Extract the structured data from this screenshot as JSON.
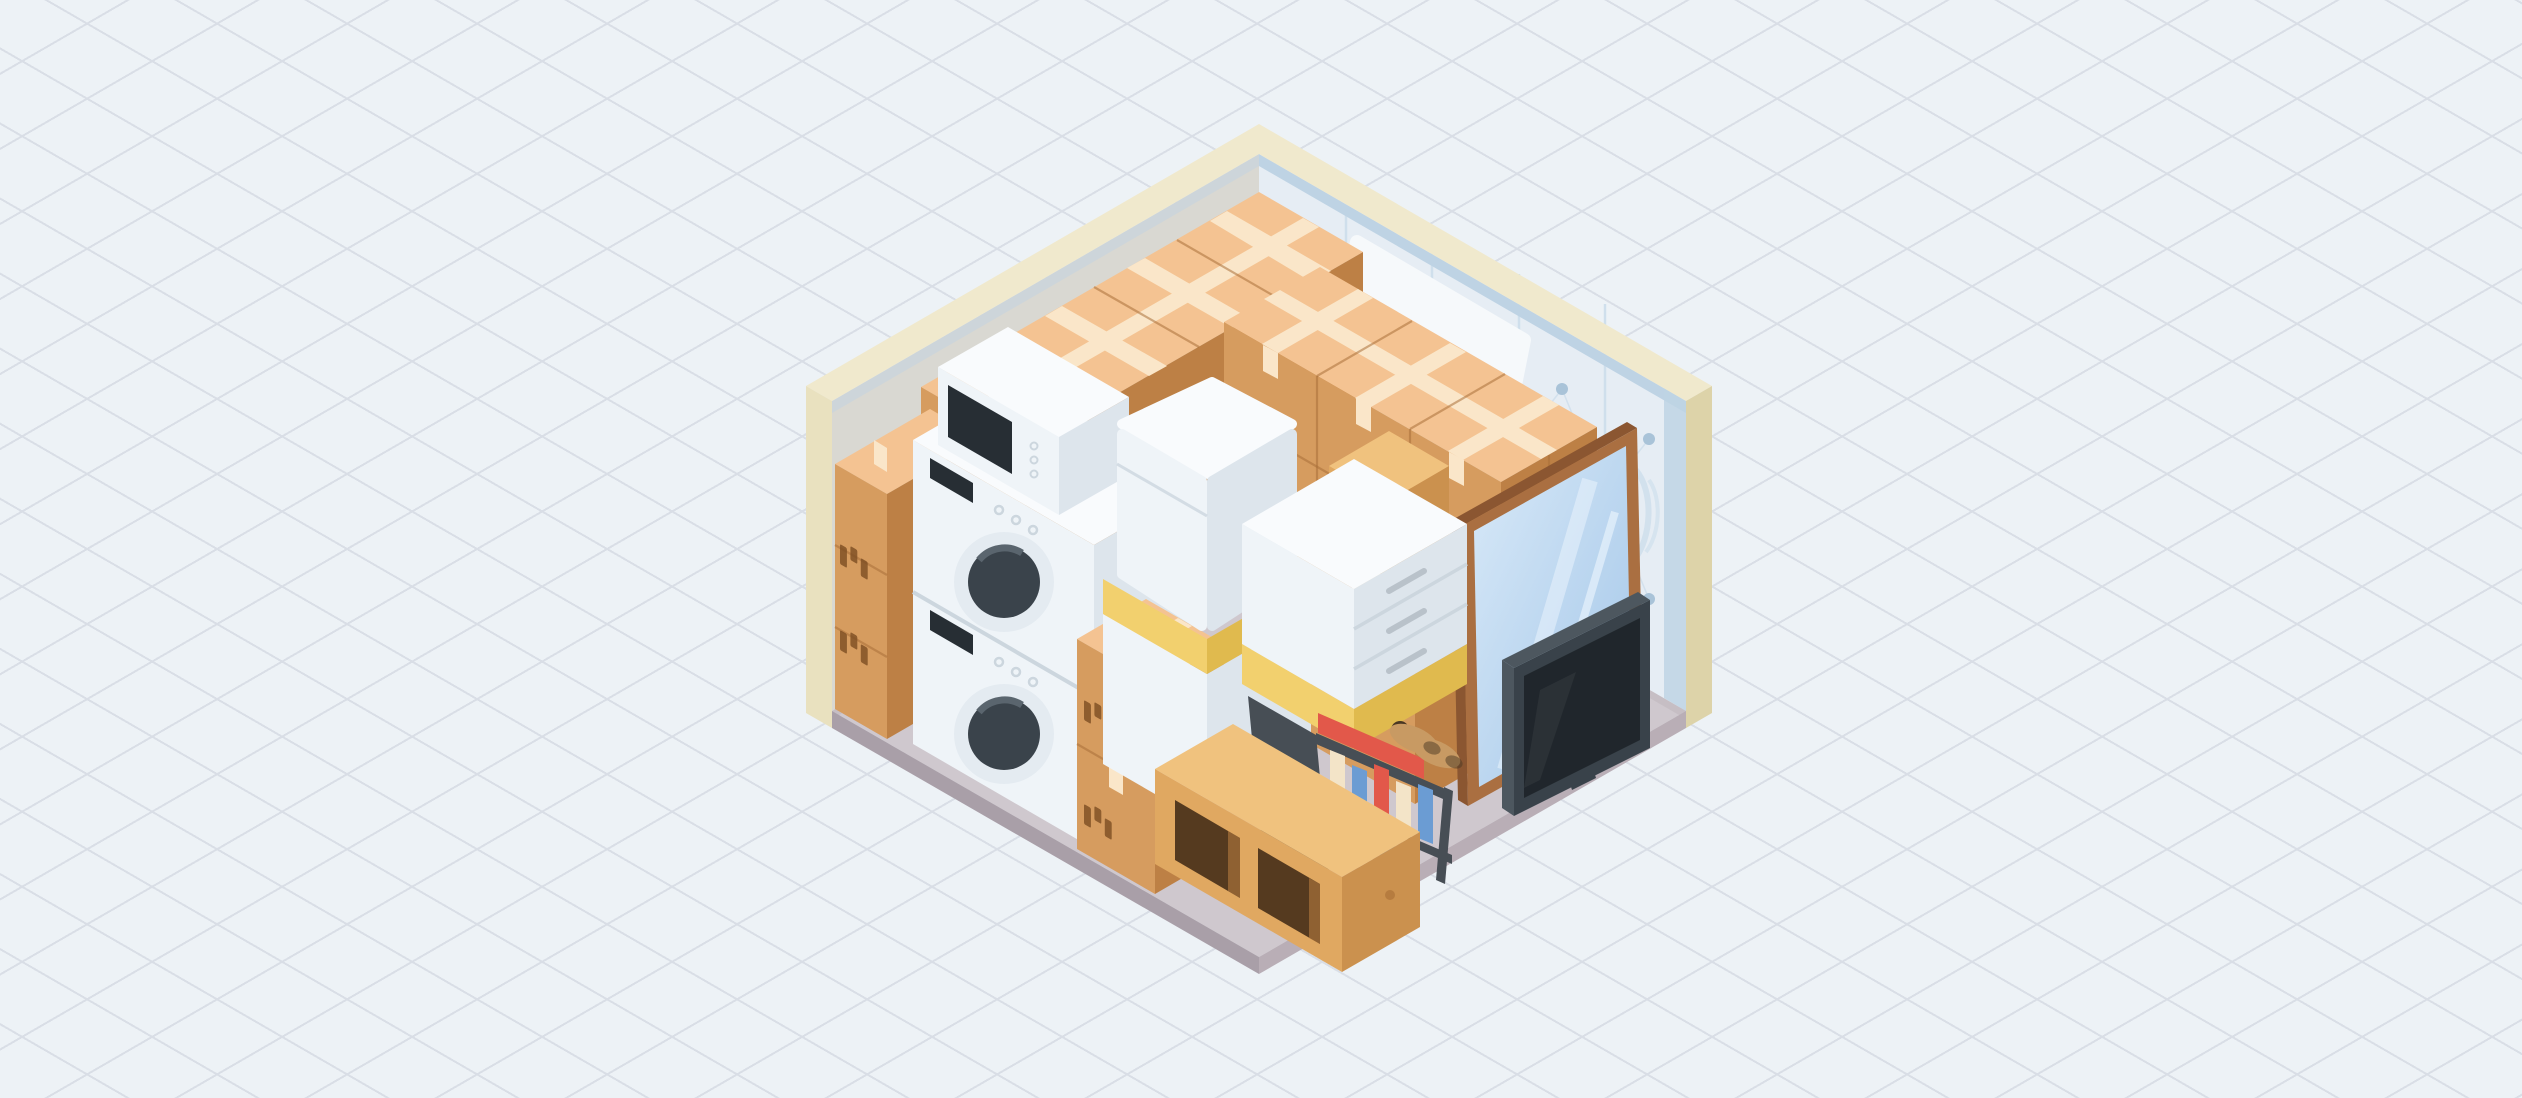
{
  "scene": {
    "name": "packed-self-storage-unit",
    "style": "isometric-cutaway-illustration",
    "background": "isometric-diamond-grid",
    "items": [
      "cardboard-box-wall-left",
      "cardboard-box-wall-back",
      "corner-box-column",
      "leaning-mattress",
      "stacked-washer-dryer",
      "microwave",
      "front-box-stack",
      "white-cabinet-with-mattress",
      "white-dresser-on-pallet",
      "wooden-crate",
      "box-block-right",
      "metal-book-rack",
      "pair-of-shoes",
      "wooden-storage-cubby",
      "flat-screen-tv",
      "wood-framed-mirror",
      "quilted-wall-padding"
    ]
  },
  "colors": {
    "bg": "#edf2f6",
    "grid": "#d9dee6",
    "wall_top": "#f0e9cd",
    "wall_end": "#e9e1bf",
    "wall_end_shade": "#ddd3a9",
    "wall_inner_left": "#d9d8d2",
    "wall_inner_right": "#e6edf4",
    "quilt_trim": "#bed3e4",
    "quilt_seam": "#cfdfec",
    "quilt_button": "#a9c3d8",
    "floor_top": "#cfc8ce",
    "floor_edge_r": "#b9aeb6",
    "floor_edge_l": "#a99fa8",
    "floor_base_shadow": "#c3bcc2",
    "box_top": "#f4c392",
    "box_tape": "#fae6c9",
    "box_dl": "#d69c5f",
    "box_dr": "#bd8045",
    "box_seam": "#a96f38",
    "box_label": "#7d4e23",
    "white_top": "#f9fbfd",
    "white_dl": "#eff4f8",
    "white_dr": "#dde5ec",
    "white_line": "#ccd6de",
    "door_ring": "#e4ebf1",
    "door_glass": "#3a434b",
    "door_glass_hi": "#5a656e",
    "appliance_slot": "#272e34",
    "yellow": "#f2d06e",
    "yellow_dark": "#e0ba4e",
    "wood_top": "#f0c27e",
    "wood_dl": "#e0a861",
    "wood_dr": "#cb914e",
    "wood_knot": "#b67c3f",
    "hole_dark": "#553a1f",
    "rack": "#474e55",
    "rack_light": "#596168",
    "book_red": "#e2584a",
    "book_blue": "#6b9cd3",
    "book_cream": "#f3e4c8",
    "book_white": "#fbfbf9",
    "shoe": "#c89a63",
    "shoe_dark": "#4a3723",
    "tv_frame": "#39424a",
    "tv_screen": "#20262c",
    "tv_side": "#4d575f",
    "tv_stand": "#434c54",
    "mirror_frame": "#aa6f41",
    "mirror_frame_dark": "#8b5631",
    "mirror_glass_a": "#d8e9f8",
    "mirror_glass_b": "#a3c6e8",
    "mirror_streak": "#eef6fd",
    "mattress": "#f6f9fb",
    "mattress_edge": "#e3eaf0"
  }
}
